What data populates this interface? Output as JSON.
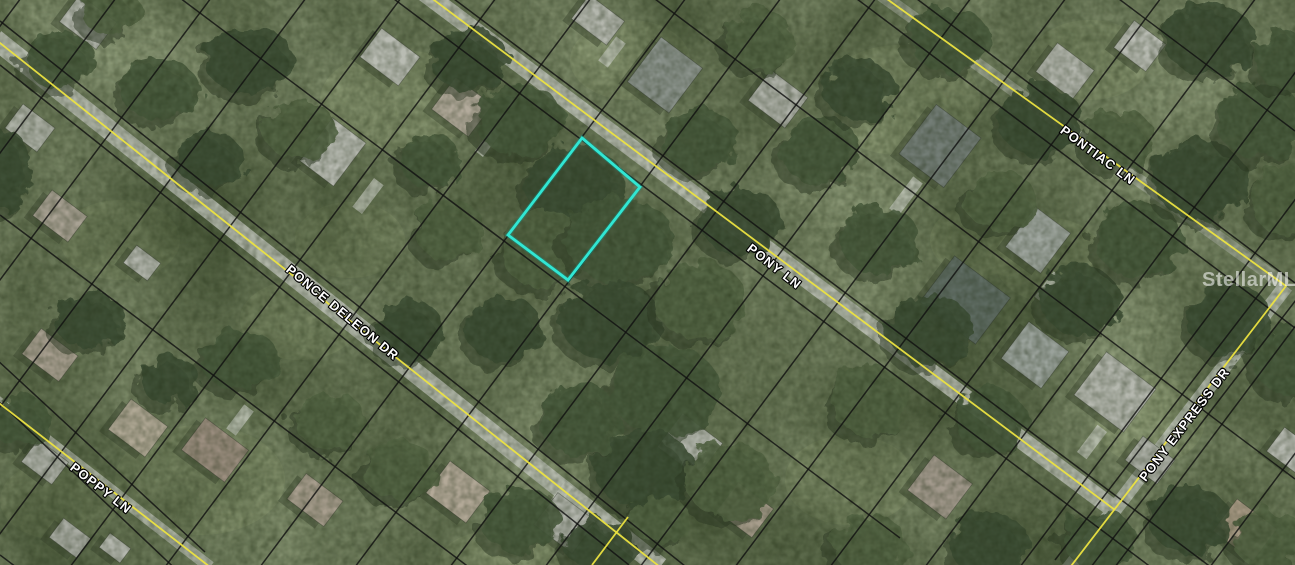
{
  "map": {
    "watermark": "StellarMLS",
    "streets": [
      {
        "name": "PONCE DELEON DR",
        "x": 288,
        "y": 260,
        "angle": 39.5
      },
      {
        "name": "POPPY LN",
        "x": 72,
        "y": 458,
        "angle": 38
      },
      {
        "name": "PONY LN",
        "x": 749,
        "y": 239,
        "angle": 38
      },
      {
        "name": "PONTIAC LN",
        "x": 1062,
        "y": 121,
        "angle": 36.5
      },
      {
        "name": "PONY EXPRESS DR",
        "x": 1142,
        "y": 472,
        "angle": -52.5
      }
    ],
    "parcel_highlight": {
      "points": "582,138 640,187 568,280 508,235",
      "color": "#31e6d3"
    },
    "colors": {
      "base": "#8d9a78",
      "grass": "#a2af85",
      "pavement": "#b9beb3",
      "driveway": "#c7cbc0",
      "road_line": "#ece340",
      "parcel_line": "#111111",
      "tree_palette": [
        "#3d4f35",
        "#495b3e",
        "#556746",
        "#617150"
      ],
      "tree_shadow": "#2e3a26",
      "house_shadow": "#39452f"
    },
    "roads": [
      {
        "pts": [
          [
            -5,
            39
          ],
          [
            660,
            567
          ]
        ],
        "w": 20,
        "op": 0.9
      },
      {
        "pts": [
          [
            418,
            -12
          ],
          [
            1115,
            510
          ]
        ],
        "w": 18,
        "op": 0.9
      },
      {
        "pts": [
          [
            880,
            -6
          ],
          [
            1286,
            286
          ]
        ],
        "w": 13,
        "op": 0.5
      },
      {
        "pts": [
          [
            1286,
            286
          ],
          [
            1068,
            570
          ]
        ],
        "w": 15,
        "op": 0.85
      },
      {
        "pts": [
          [
            -5,
            400
          ],
          [
            210,
            567
          ]
        ],
        "w": 12,
        "op": 0.75
      }
    ],
    "yellow_lines": [
      [
        [
          -5,
          39
        ],
        [
          660,
          567
        ]
      ],
      [
        [
          628,
          517
        ],
        [
          592,
          565
        ]
      ],
      [
        [
          418,
          -12
        ],
        [
          1115,
          510
        ]
      ],
      [
        [
          880,
          -6
        ],
        [
          1286,
          286
        ],
        [
          1068,
          570
        ]
      ],
      [
        [
          -5,
          400
        ],
        [
          210,
          567
        ]
      ]
    ],
    "parcel_lines": [
      [
        [
          0,
          21
        ],
        [
          685,
          566
        ]
      ],
      [
        [
          0,
          65
        ],
        [
          629,
          565
        ]
      ],
      [
        [
          100,
          -62
        ],
        [
          900,
          538
        ]
      ],
      [
        [
          382,
          -10
        ],
        [
          1160,
          574
        ]
      ],
      [
        [
          442,
          -10
        ],
        [
          1220,
          574
        ]
      ],
      [
        [
          643,
          -10
        ],
        [
          1295,
          479
        ]
      ],
      [
        [
          845,
          -10
        ],
        [
          1295,
          328
        ]
      ],
      [
        [
          905,
          -10
        ],
        [
          1295,
          283
        ]
      ],
      [
        [
          0,
          215
        ],
        [
          470,
          568
        ]
      ],
      [
        [
          -5,
          358
        ],
        [
          205,
          552
        ]
      ],
      [
        [
          -5,
          398
        ],
        [
          185,
          578
        ]
      ],
      [
        [
          0,
          555
        ],
        [
          20,
          570
        ]
      ],
      [
        [
          1107,
          -10
        ],
        [
          1295,
          131
        ]
      ],
      [
        [
          1299,
          296
        ],
        [
          1081,
          580
        ]
      ],
      [
        [
          1273,
          276
        ],
        [
          1055,
          560
        ]
      ],
      [
        [
          27,
          -10
        ],
        [
          -411,
          575
        ]
      ],
      [
        [
          122,
          -10
        ],
        [
          -316,
          575
        ]
      ],
      [
        [
          217,
          -10
        ],
        [
          -221,
          575
        ]
      ],
      [
        [
          312,
          -10
        ],
        [
          -126,
          575
        ]
      ],
      [
        [
          407,
          -10
        ],
        [
          -31,
          575
        ]
      ],
      [
        [
          502,
          -10
        ],
        [
          64,
          575
        ]
      ],
      [
        [
          597,
          -10
        ],
        [
          159,
          575
        ]
      ],
      [
        [
          692,
          -10
        ],
        [
          254,
          575
        ]
      ],
      [
        [
          787,
          -10
        ],
        [
          349,
          575
        ]
      ],
      [
        [
          882,
          -10
        ],
        [
          444,
          575
        ]
      ],
      [
        [
          977,
          -10
        ],
        [
          539,
          575
        ]
      ],
      [
        [
          1072,
          -10
        ],
        [
          634,
          575
        ]
      ],
      [
        [
          1167,
          -10
        ],
        [
          729,
          575
        ]
      ],
      [
        [
          1262,
          -10
        ],
        [
          824,
          575
        ]
      ],
      [
        [
          1357,
          -10
        ],
        [
          919,
          575
        ]
      ],
      [
        [
          1452,
          -10
        ],
        [
          1014,
          575
        ]
      ],
      [
        [
          1547,
          -10
        ],
        [
          1109,
          575
        ]
      ],
      [
        [
          1642,
          -10
        ],
        [
          1204,
          575
        ]
      ]
    ],
    "houses": [
      [
        88,
        22,
        46,
        34,
        "#b4b7ae"
      ],
      [
        30,
        128,
        40,
        30,
        "#adb1a6"
      ],
      [
        60,
        216,
        44,
        32,
        "#a9a294"
      ],
      [
        142,
        263,
        30,
        22,
        "#b2b5ac"
      ],
      [
        333,
        152,
        42,
        54,
        "#b6b9b0"
      ],
      [
        390,
        57,
        48,
        36,
        "#b9bcb3"
      ],
      [
        462,
        107,
        46,
        40,
        "#b3ab9c"
      ],
      [
        598,
        20,
        44,
        30,
        "#b4b7ae"
      ],
      [
        665,
        75,
        52,
        56,
        "#8b938c"
      ],
      [
        778,
        99,
        46,
        38,
        "#aeb1a8"
      ],
      [
        940,
        146,
        56,
        62,
        "#737d76"
      ],
      [
        1038,
        240,
        44,
        50,
        "#9fa69f"
      ],
      [
        1065,
        71,
        46,
        36,
        "#b2b5ac"
      ],
      [
        1140,
        46,
        40,
        34,
        "#b7bab1"
      ],
      [
        50,
        355,
        46,
        32,
        "#a9a091"
      ],
      [
        138,
        428,
        46,
        38,
        "#b0a895"
      ],
      [
        215,
        450,
        54,
        40,
        "#9a8d7e"
      ],
      [
        315,
        500,
        46,
        32,
        "#a89e8e"
      ],
      [
        458,
        492,
        50,
        40,
        "#b3a998"
      ],
      [
        565,
        523,
        48,
        40,
        "#b0b3aa"
      ],
      [
        45,
        462,
        38,
        28,
        "#adb0a7"
      ],
      [
        70,
        538,
        34,
        24,
        "#a9aca3"
      ],
      [
        115,
        548,
        26,
        18,
        "#b4b7ae"
      ],
      [
        690,
        445,
        50,
        42,
        "#b7bab1"
      ],
      [
        940,
        487,
        48,
        44,
        "#a39a8d"
      ],
      [
        745,
        510,
        44,
        36,
        "#a79d8c"
      ],
      [
        965,
        300,
        70,
        58,
        "#5f6c63"
      ],
      [
        1035,
        355,
        50,
        46,
        "#9aa29b"
      ],
      [
        1115,
        392,
        62,
        54,
        "#b5b8af"
      ],
      [
        1150,
        460,
        40,
        30,
        "#aeb1a8"
      ],
      [
        1245,
        530,
        50,
        40,
        "#a89a85"
      ],
      [
        1290,
        450,
        36,
        30,
        "#b5b8af"
      ]
    ],
    "driveways": [
      [
        368,
        196,
        12,
        36
      ],
      [
        488,
        142,
        10,
        30
      ],
      [
        906,
        196,
        12,
        40
      ],
      [
        1048,
        287,
        10,
        32
      ],
      [
        612,
        52,
        12,
        30
      ],
      [
        1092,
        442,
        12,
        34
      ],
      [
        560,
        496,
        10,
        30
      ],
      [
        240,
        420,
        12,
        30
      ]
    ],
    "trees": [
      [
        470,
        60,
        40,
        30,
        0
      ],
      [
        520,
        120,
        45,
        35,
        1
      ],
      [
        575,
        185,
        50,
        40,
        0
      ],
      [
        545,
        250,
        45,
        38,
        2
      ],
      [
        620,
        240,
        55,
        42,
        1
      ],
      [
        610,
        320,
        50,
        40,
        0
      ],
      [
        665,
        390,
        55,
        45,
        1
      ],
      [
        700,
        300,
        45,
        40,
        2
      ],
      [
        740,
        220,
        40,
        35,
        0
      ],
      [
        700,
        140,
        38,
        32,
        1
      ],
      [
        760,
        40,
        35,
        30,
        2
      ],
      [
        820,
        150,
        40,
        34,
        1
      ],
      [
        645,
        470,
        50,
        40,
        0
      ],
      [
        730,
        480,
        45,
        38,
        2
      ],
      [
        580,
        420,
        40,
        36,
        1
      ],
      [
        505,
        330,
        38,
        34,
        0
      ],
      [
        450,
        230,
        35,
        30,
        2
      ],
      [
        430,
        160,
        30,
        28,
        1
      ],
      [
        860,
        90,
        36,
        30,
        0
      ],
      [
        880,
        240,
        40,
        34,
        1
      ],
      [
        930,
        330,
        42,
        36,
        0
      ],
      [
        870,
        400,
        40,
        36,
        2
      ],
      [
        990,
        420,
        36,
        32,
        1
      ],
      [
        1080,
        300,
        40,
        34,
        0
      ],
      [
        1140,
        240,
        44,
        38,
        1
      ],
      [
        1200,
        180,
        46,
        40,
        0
      ],
      [
        1260,
        120,
        44,
        38,
        1
      ],
      [
        1290,
        200,
        40,
        36,
        2
      ],
      [
        1230,
        320,
        42,
        36,
        0
      ],
      [
        1290,
        360,
        38,
        34,
        1
      ],
      [
        1190,
        520,
        40,
        34,
        0
      ],
      [
        1270,
        540,
        36,
        30,
        2
      ],
      [
        1100,
        540,
        36,
        30,
        1
      ],
      [
        990,
        545,
        40,
        32,
        0
      ],
      [
        870,
        545,
        38,
        30,
        2
      ],
      [
        950,
        40,
        40,
        32,
        1
      ],
      [
        1040,
        120,
        42,
        36,
        0
      ],
      [
        1120,
        140,
        36,
        30,
        2
      ],
      [
        1210,
        40,
        46,
        36,
        0
      ],
      [
        1290,
        60,
        36,
        30,
        1
      ],
      [
        1000,
        200,
        36,
        30,
        2
      ],
      [
        250,
        60,
        45,
        34,
        0
      ],
      [
        160,
        90,
        40,
        30,
        1
      ],
      [
        300,
        130,
        36,
        30,
        2
      ],
      [
        210,
        160,
        34,
        28,
        0
      ],
      [
        60,
        60,
        36,
        28,
        1
      ],
      [
        5,
        170,
        28,
        40,
        0
      ],
      [
        110,
        10,
        30,
        24,
        2
      ],
      [
        90,
        320,
        36,
        28,
        0
      ],
      [
        240,
        360,
        40,
        30,
        1
      ],
      [
        330,
        420,
        36,
        28,
        2
      ],
      [
        170,
        380,
        30,
        24,
        0
      ],
      [
        20,
        420,
        30,
        26,
        1
      ],
      [
        410,
        330,
        34,
        30,
        0
      ],
      [
        400,
        470,
        36,
        30,
        2
      ],
      [
        520,
        520,
        40,
        32,
        1
      ],
      [
        600,
        545,
        36,
        26,
        0
      ],
      [
        660,
        520,
        30,
        24,
        2
      ]
    ],
    "grass": [
      [
        120,
        240,
        60,
        40
      ],
      [
        400,
        100,
        80,
        50
      ],
      [
        900,
        100,
        80,
        55
      ],
      [
        1050,
        260,
        55,
        42
      ],
      [
        200,
        480,
        85,
        55
      ],
      [
        850,
        480,
        65,
        45
      ],
      [
        1150,
        420,
        55,
        45
      ],
      [
        350,
        240,
        55,
        38
      ],
      [
        630,
        60,
        60,
        40
      ],
      [
        1090,
        60,
        60,
        40
      ],
      [
        60,
        500,
        60,
        40
      ],
      [
        500,
        560,
        60,
        30
      ],
      [
        980,
        240,
        50,
        36
      ],
      [
        300,
        320,
        60,
        40
      ]
    ]
  }
}
